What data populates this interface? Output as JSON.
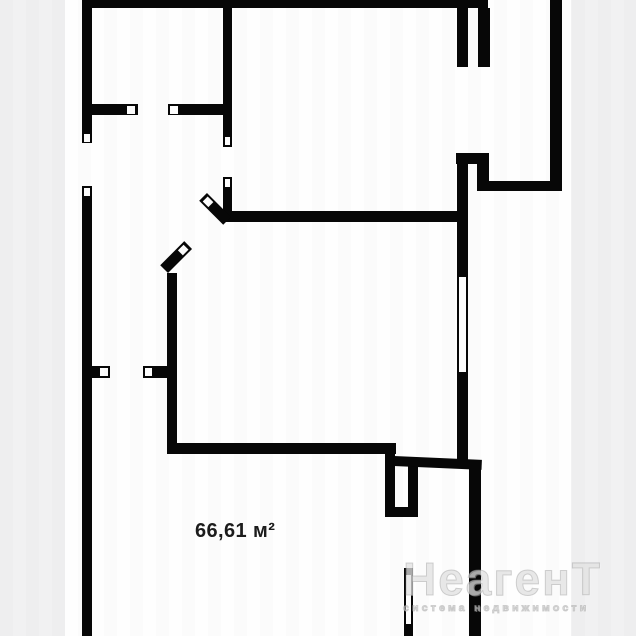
{
  "page": {
    "background_color": "#fefefe",
    "margin_strip_color": "#f1f1f2"
  },
  "floor_plan": {
    "area_label": "66,61 м²",
    "wall_color": "#070707",
    "label_color": "#1c1c1c"
  },
  "watermark": {
    "brand_start": "Неаген",
    "brand_end": "Т",
    "tagline": "система недвижимости",
    "color": "#d9d9d9"
  }
}
